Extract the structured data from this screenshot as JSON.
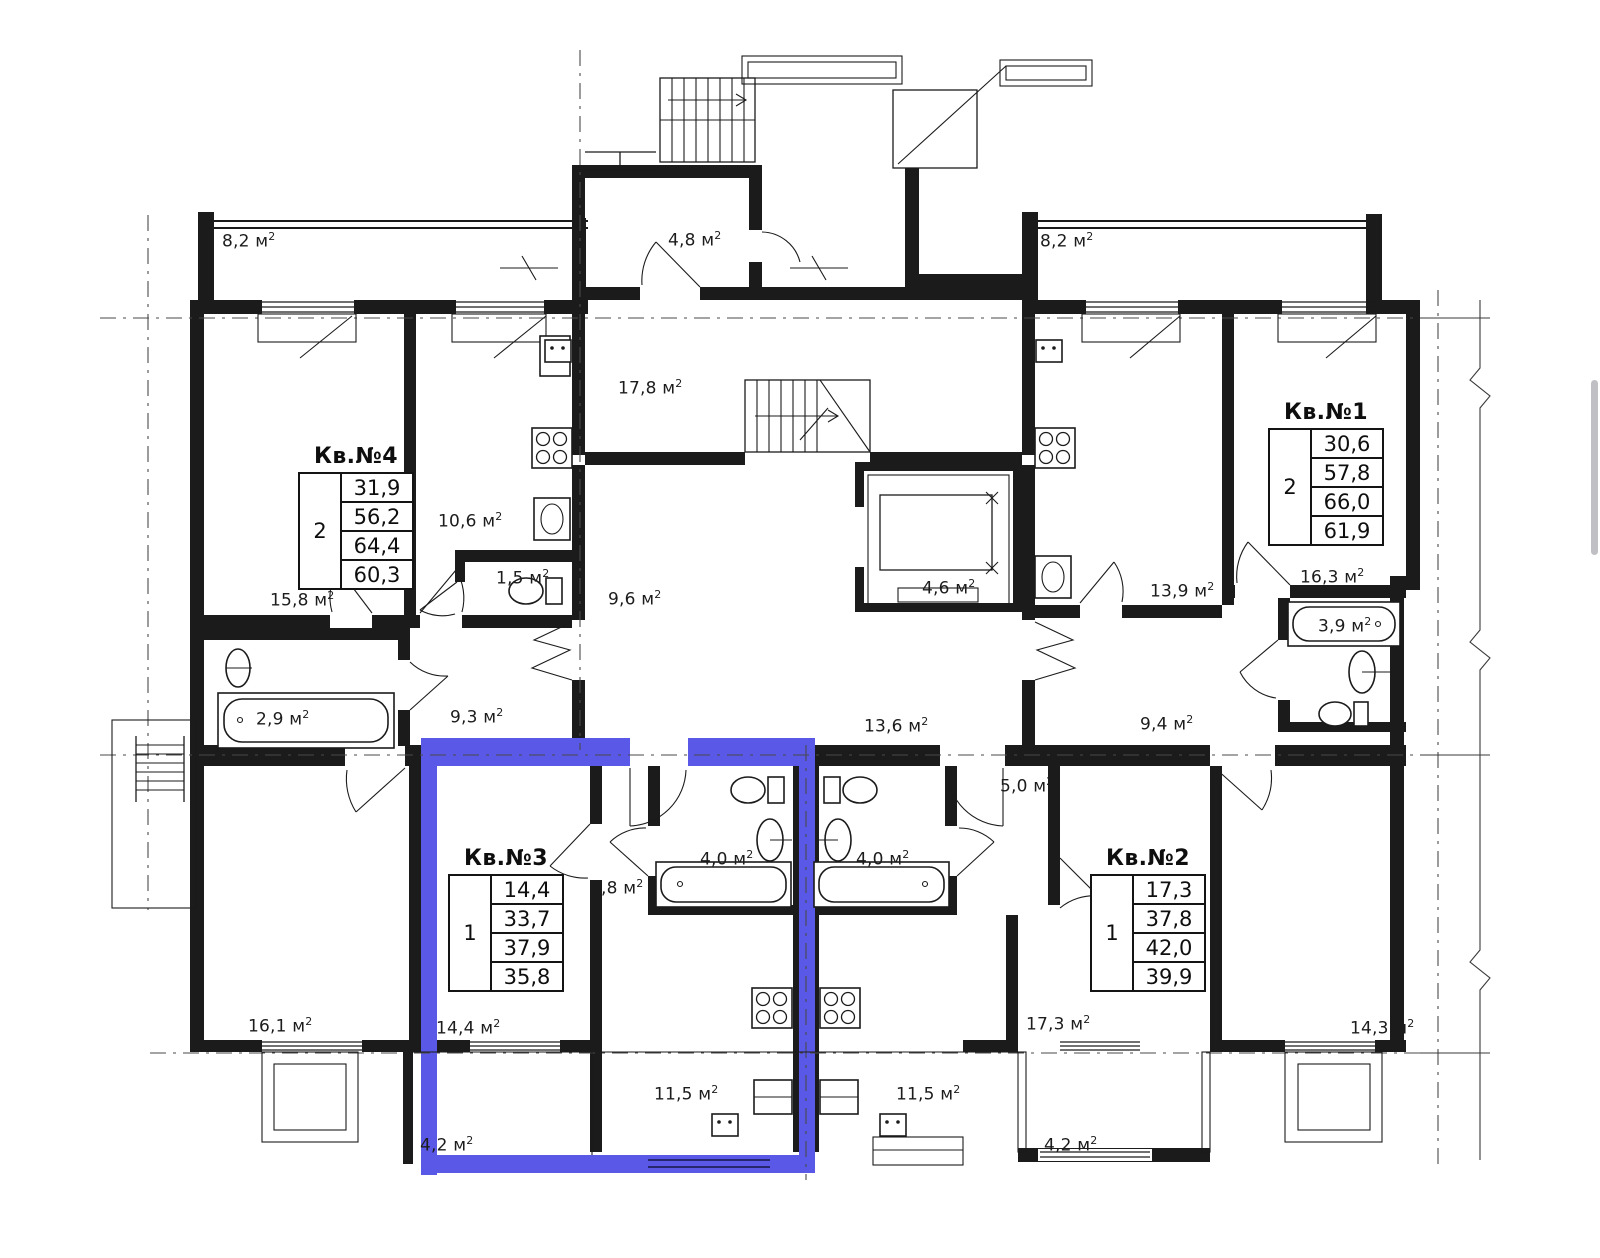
{
  "plan": {
    "highlight_color": "#5a58e6",
    "line_color": "#1b1b1b",
    "highlighted_apartment": "Кв.№3"
  },
  "apartments": [
    {
      "id": "kv4",
      "title": "Кв.№4",
      "rooms": "2",
      "areas": [
        "31,9",
        "56,2",
        "64,4",
        "60,3"
      ]
    },
    {
      "id": "kv1",
      "title": "Кв.№1",
      "rooms": "2",
      "areas": [
        "30,6",
        "57,8",
        "66,0",
        "61,9"
      ]
    },
    {
      "id": "kv3",
      "title": "Кв.№3",
      "rooms": "1",
      "areas": [
        "14,4",
        "33,7",
        "37,9",
        "35,8"
      ]
    },
    {
      "id": "kv2",
      "title": "Кв.№2",
      "rooms": "1",
      "areas": [
        "17,3",
        "37,8",
        "42,0",
        "39,9"
      ]
    }
  ],
  "labels": [
    {
      "text": "8,2 м",
      "sup": "2"
    },
    {
      "text": "4,8 м",
      "sup": "2"
    },
    {
      "text": "8,2 м",
      "sup": "2"
    },
    {
      "text": "17,8 м",
      "sup": "2"
    },
    {
      "text": "10,6 м",
      "sup": "2"
    },
    {
      "text": "1,5 м",
      "sup": "2"
    },
    {
      "text": "9,6 м",
      "sup": "2"
    },
    {
      "text": "4,6 м",
      "sup": "2"
    },
    {
      "text": "13,9 м",
      "sup": "2"
    },
    {
      "text": "16,3 м",
      "sup": "2"
    },
    {
      "text": "3,9 м",
      "sup": "2"
    },
    {
      "text": "15,8 м",
      "sup": "2"
    },
    {
      "text": "2,9 м",
      "sup": "2"
    },
    {
      "text": "9,3 м",
      "sup": "2"
    },
    {
      "text": "13,6 м",
      "sup": "2"
    },
    {
      "text": "9,4 м",
      "sup": "2"
    },
    {
      "text": "5,0 м",
      "sup": "2"
    },
    {
      "text": "3,8 м",
      "sup": "2"
    },
    {
      "text": "4,0 м",
      "sup": "2"
    },
    {
      "text": "4,0 м",
      "sup": "2"
    },
    {
      "text": "16,1 м",
      "sup": "2"
    },
    {
      "text": "14,4 м",
      "sup": "2"
    },
    {
      "text": "17,3 м",
      "sup": "2"
    },
    {
      "text": "14,3 м",
      "sup": "2"
    },
    {
      "text": "11,5 м",
      "sup": "2"
    },
    {
      "text": "11,5 м",
      "sup": "2"
    },
    {
      "text": "4,2 м",
      "sup": "2"
    },
    {
      "text": "4,2 м",
      "sup": "2"
    }
  ]
}
